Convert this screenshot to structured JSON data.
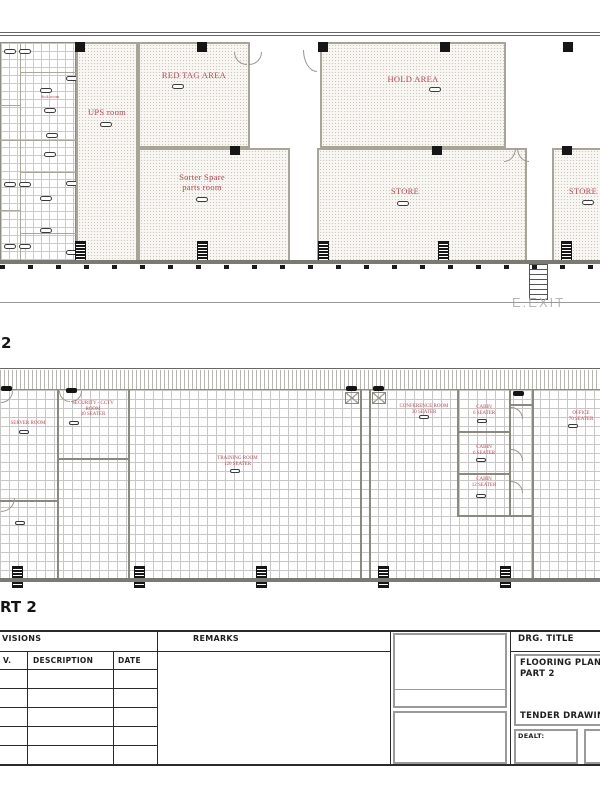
{
  "colors": {
    "label_red": "#c0454f",
    "wall_gray": "#8b897e",
    "exit_gray": "#b5b5b5",
    "line_black": "#2a2a2a"
  },
  "plan1": {
    "caption": "2",
    "exit_label": "E.EXIT",
    "rooms": {
      "ups": {
        "label": "UPS room"
      },
      "red_tag": {
        "label": "RED TAG AREA"
      },
      "hold": {
        "label": "HOLD AREA"
      },
      "sorter": {
        "line1": "Sorter Spare",
        "line2": "parts room"
      },
      "store1": {
        "label": "STORE"
      },
      "store2": {
        "label": "STORE"
      },
      "sick": {
        "label": "Sick room"
      }
    }
  },
  "plan2": {
    "caption": "RT 2",
    "rooms": {
      "server": {
        "line1": "SERVER ROOM"
      },
      "security": {
        "line1": "SECURITY - CCTV",
        "line2": "ROOM",
        "line3": "30 SEATER"
      },
      "training": {
        "line1": "TRAINING ROOM",
        "line2": "120 SEATER"
      },
      "conference": {
        "line1": "CONFERENCE ROOM",
        "line2": "30 SEATER"
      },
      "cabin1": {
        "line1": "CABIN",
        "line2": "6 SEATER"
      },
      "cabin2": {
        "line1": "CABIN",
        "line2": "6 SEATER"
      },
      "cabin3": {
        "line1": "CABIN",
        "line2": "12 SEATER"
      },
      "office": {
        "line1": "OFFICE",
        "line2": "70 SEATER"
      }
    }
  },
  "title_block": {
    "revisions_header": "VISIONS",
    "columns": {
      "rev": "V.",
      "description": "DESCRIPTION",
      "date": "DATE"
    },
    "remarks_header": "REMARKS",
    "drg_title_label": "DRG.  TITLE",
    "drawing_title_line1": "FLOORING PLAN",
    "drawing_title_line2": "PART 2",
    "drawing_stage": "TENDER DRAWING",
    "dealt_label": "DEALT:"
  }
}
